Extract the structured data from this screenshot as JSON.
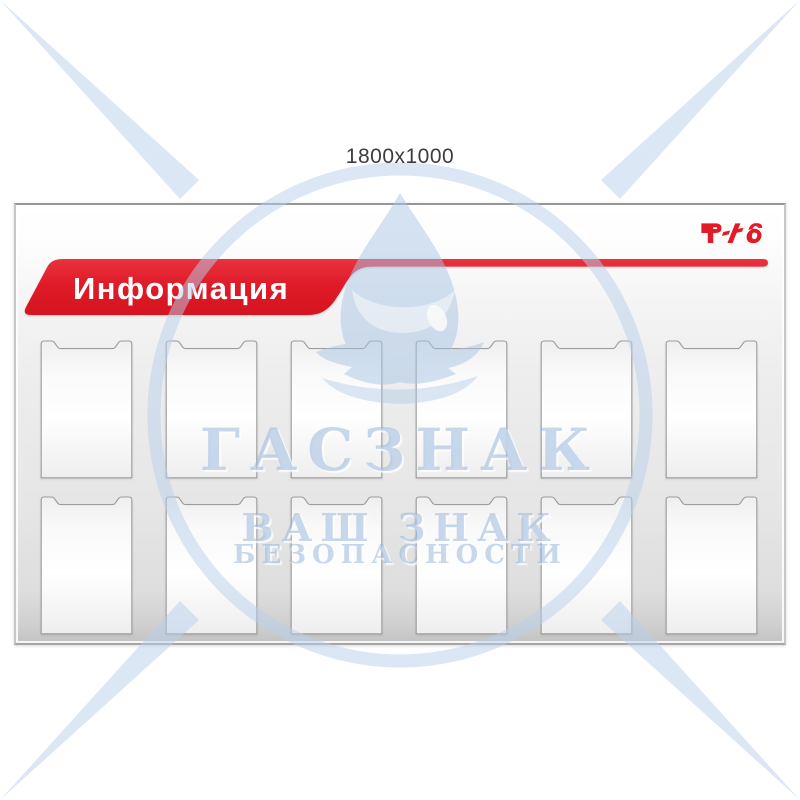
{
  "product": {
    "size_label": "1800x1000"
  },
  "board": {
    "title": "Информация",
    "brand_logo": "РЖД",
    "pockets": {
      "rows": 2,
      "columns": 6,
      "count": 12
    }
  },
  "watermark": {
    "brand": "ГАСЗНАК",
    "tagline_line1": "ВАШ ЗНАК",
    "tagline_line2": "БЕЗОПАСНОСТИ"
  },
  "colors": {
    "accent_red": "#e01b28",
    "watermark_blue": "#b7cfea",
    "board_gray": "#e6e6e6",
    "pocket_border": "#9c9c9c"
  }
}
